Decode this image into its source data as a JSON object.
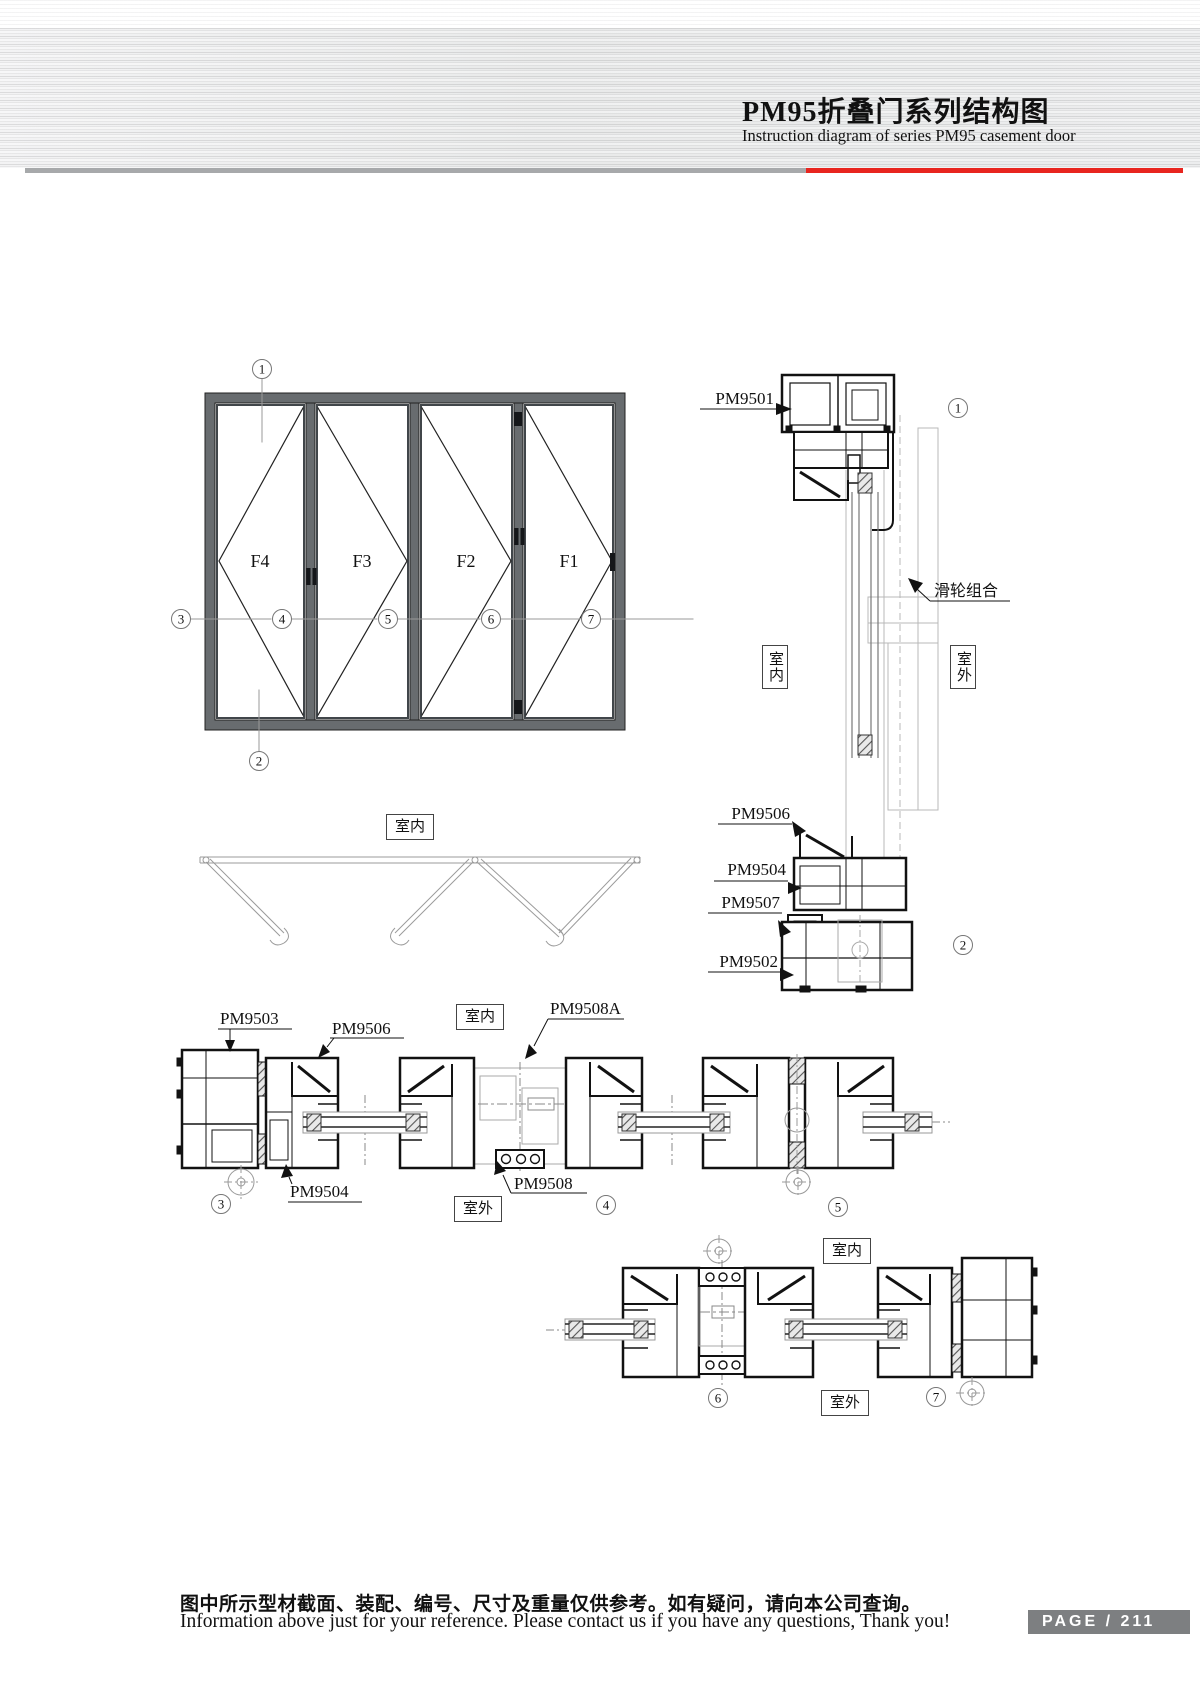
{
  "header": {
    "title_cn": "PM95折叠门系列结构图",
    "title_en": "Instruction diagram of series PM95 casement door"
  },
  "labels": {
    "indoor": "室内",
    "outdoor": "室外",
    "pulley": "滑轮组合",
    "pm9501": "PM9501",
    "pm9502": "PM9502",
    "pm9503": "PM9503",
    "pm9504": "PM9504",
    "pm9506": "PM9506",
    "pm9507": "PM9507",
    "pm9508": "PM9508",
    "pm9508a": "PM9508A"
  },
  "elevation": {
    "panels": [
      "F4",
      "F3",
      "F2",
      "F1"
    ]
  },
  "markers": {
    "n1": "1",
    "n2": "2",
    "n3": "3",
    "n4": "4",
    "n5": "5",
    "n6": "6",
    "n7": "7"
  },
  "footer": {
    "note_cn": "图中所示型材截面、装配、编号、尺寸及重量仅供参考。如有疑问，请向本公司查询。",
    "note_en": "Information above just for your reference. Please contact us if you have any questions, Thank you!",
    "page_label": "PAGE / 211"
  }
}
